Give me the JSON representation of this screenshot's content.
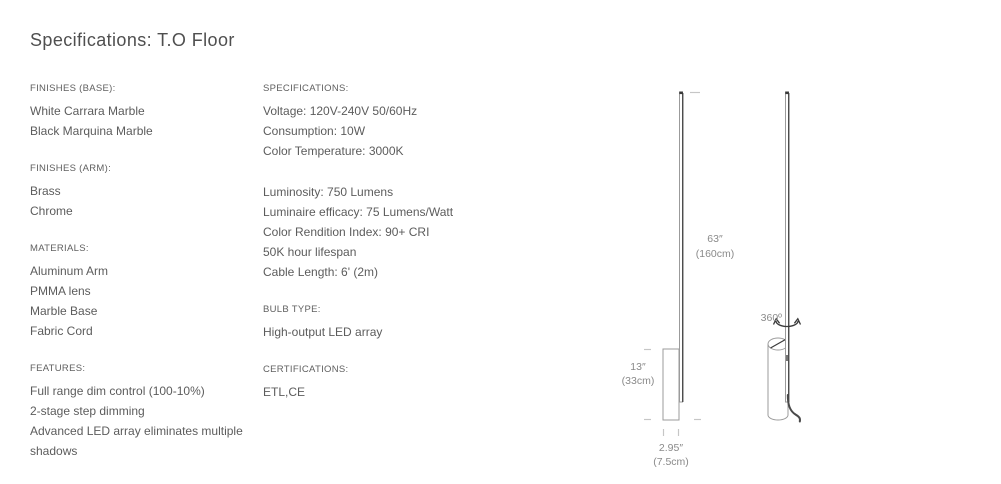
{
  "page": {
    "title": "Specifications: T.O Floor"
  },
  "left_column": {
    "sections": [
      {
        "heading": "FINISHES (BASE):",
        "lines": [
          "White Carrara Marble",
          "Black Marquina Marble"
        ]
      },
      {
        "heading": "FINISHES (ARM):",
        "lines": [
          "Brass",
          "Chrome"
        ]
      },
      {
        "heading": "MATERIALS:",
        "lines": [
          "Aluminum Arm",
          "PMMA lens",
          "Marble Base",
          "Fabric Cord"
        ]
      },
      {
        "heading": "FEATURES:",
        "lines": [
          "Full range dim control (100-10%)",
          "2-stage step dimming",
          "Advanced LED array eliminates multiple shadows"
        ]
      }
    ]
  },
  "middle_column": {
    "sections": [
      {
        "heading": "SPECIFICATIONS:",
        "lines": [
          "Voltage: 120V-240V 50/60Hz",
          "Consumption: 10W",
          "Color Temperature: 3000K"
        ]
      },
      {
        "heading": "",
        "lines": [
          "Luminosity: 750 Lumens",
          "Luminaire efficacy: 75 Lumens/Watt",
          "Color Rendition Index: 90+ CRI",
          "50K hour lifespan",
          "Cable Length: 6' (2m)"
        ]
      },
      {
        "heading": "BULB TYPE:",
        "lines": [
          "High-output LED array"
        ]
      },
      {
        "heading": "CERTIFICATIONS:",
        "lines": [
          "ETL,CE"
        ]
      }
    ]
  },
  "diagram": {
    "height_in": "63″",
    "height_cm": "(160cm)",
    "base_height_in": "13″",
    "base_height_cm": "(33cm)",
    "base_width_in": "2.95″",
    "base_width_cm": "(7.5cm)",
    "rotation_label": "360º",
    "colors": {
      "outline": "#9b9b9b",
      "dark": "#3a3a3a",
      "tick": "#c6c6c6",
      "dim_text": "#8a8a8a",
      "cord": "#4a4a4a"
    }
  }
}
